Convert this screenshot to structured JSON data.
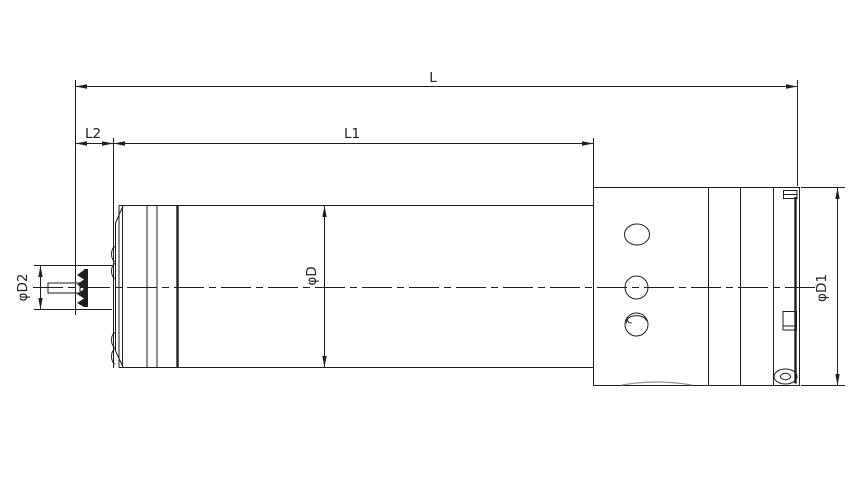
{
  "labels": {
    "overall_length": "L",
    "body_length": "L1",
    "nose_length": "L2",
    "body_diameter": "φD",
    "housing_diameter": "φD1",
    "shaft_diameter": "φD2"
  },
  "colors": {
    "line": "#1f1f1f",
    "background": "#ffffff"
  }
}
